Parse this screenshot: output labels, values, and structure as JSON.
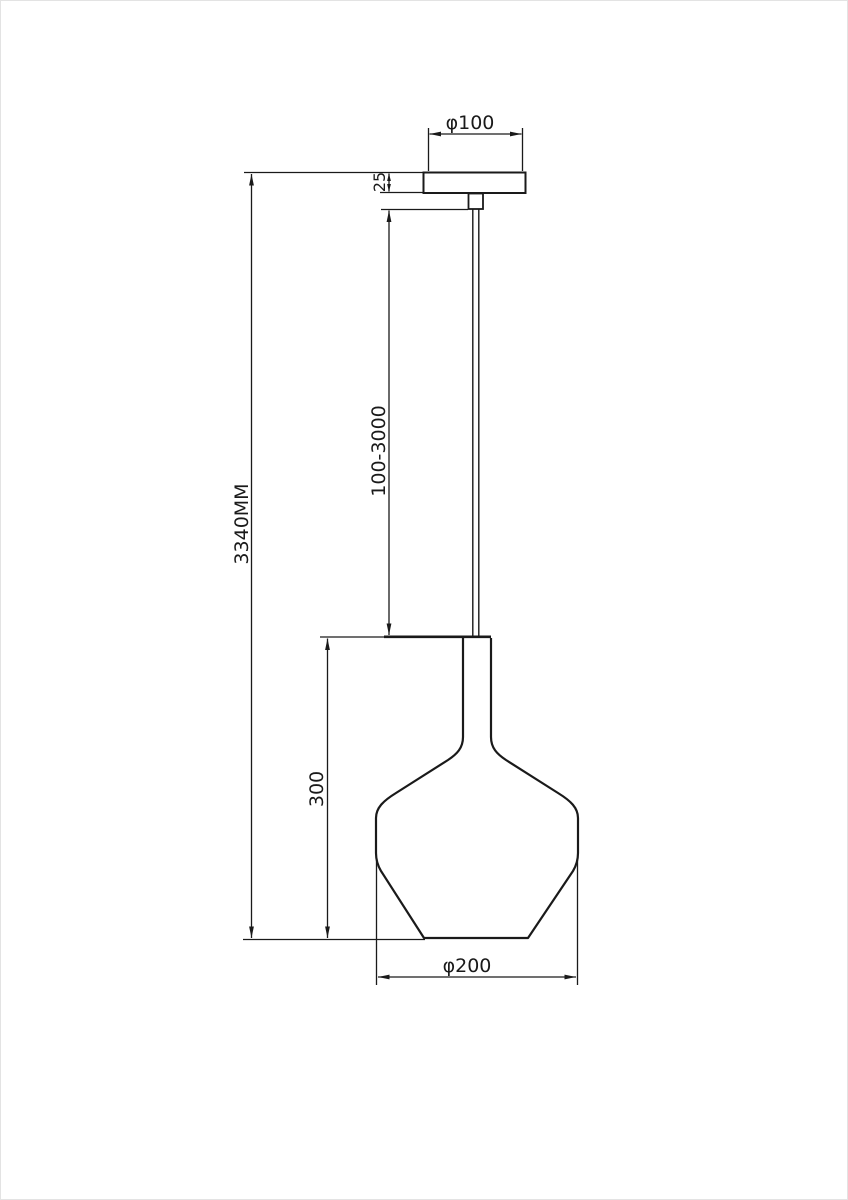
{
  "diagram": {
    "title": "pendant-lamp-dimension-drawing",
    "background_color": "#ffffff",
    "line_color": "#1a1a1a",
    "labels": {
      "canopy_diameter": "φ100",
      "canopy_height": "25",
      "cable_length_range": "100-3000",
      "total_height": "3340MM",
      "shade_height": "300",
      "shade_diameter": "φ200"
    }
  }
}
